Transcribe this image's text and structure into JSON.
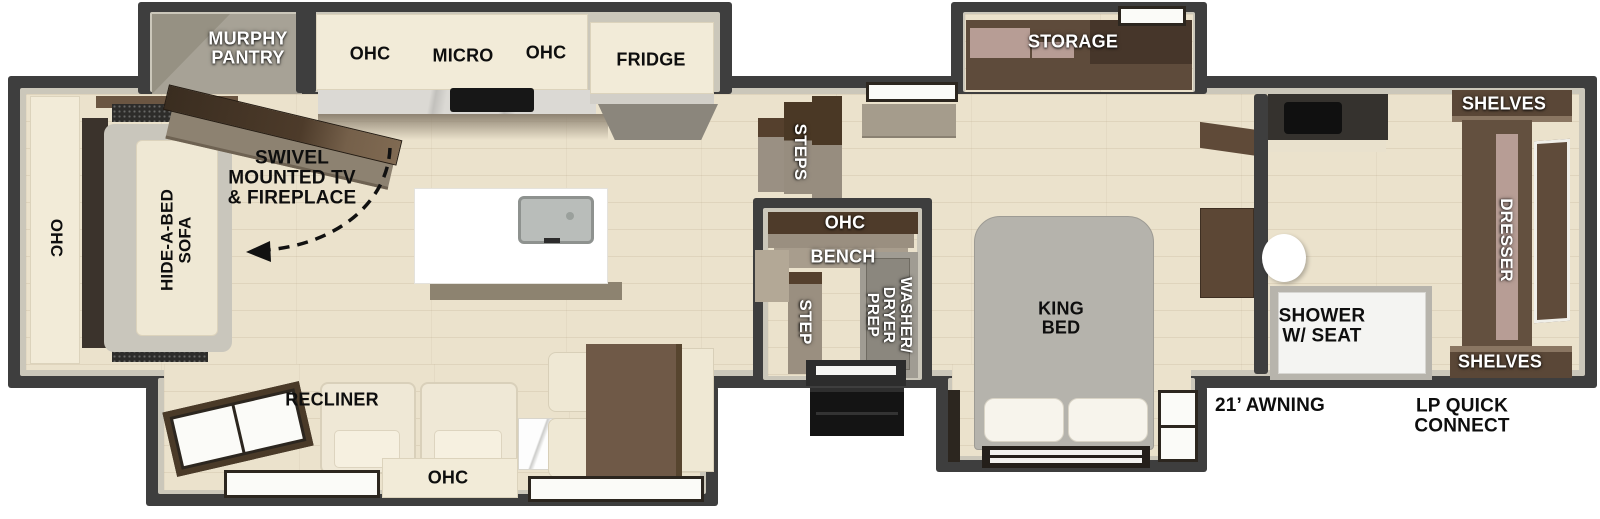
{
  "title": "RV travel trailer floor plan",
  "labels": {
    "rear": {
      "ohc_side": "OHC",
      "sofa": "HIDE-A-BED\nSOFA",
      "murphy": "MURPHY\nPANTRY",
      "swivel": "SWIVEL\nMOUNTED TV\n& FIREPLACE",
      "recliner": "RECLINER",
      "ohc_bottom": "OHC"
    },
    "kitchen": {
      "ohc_left": "OHC",
      "micro": "MICRO",
      "ohc_right": "OHC",
      "fridge": "FRIDGE"
    },
    "mid": {
      "steps": "STEPS",
      "ohc": "OHC",
      "bench": "BENCH",
      "step": "STEP",
      "washer": "WASHER/\nDRYER\nPREP"
    },
    "bedroom": {
      "storage": "STORAGE",
      "king": "KING\nBED"
    },
    "bath": {
      "shelves_top": "SHELVES",
      "dresser": "DRESSER",
      "shelves_bottom": "SHELVES",
      "shower": "SHOWER\nW/ SEAT"
    },
    "exterior": {
      "awning": "21’ AWNING",
      "lp": "LP QUICK\nCONNECT"
    }
  },
  "colors": {
    "wall": "#3e3e3e",
    "wall_lining": "#cbc7ba",
    "floor": "#ebe2cc",
    "cabinet_cream": "#f2ebd8",
    "wood_dark": "#4e3b2a",
    "wood_taupe": "#9a8f80",
    "drawer_pink": "#b79d95",
    "bed_gray": "#b5b3ac",
    "label_white": "#ffffff",
    "label_black": "#0e0e0e"
  }
}
